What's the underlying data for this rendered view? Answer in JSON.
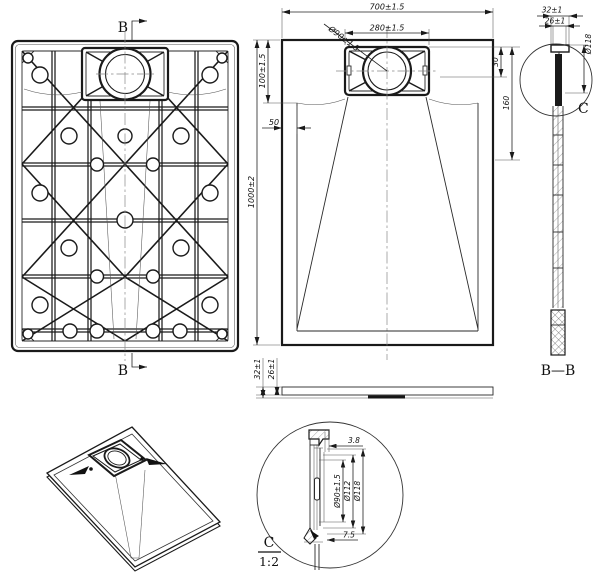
{
  "labels": {
    "section_marker": "B",
    "section_view_title": "B—B",
    "detail_marker": "C",
    "detail_title": "C",
    "detail_scale": "1:2"
  },
  "top_view": {
    "dim_width": "700±1.5",
    "dim_drain_cover_width": "280±1.5",
    "dim_drain_diameter": "Ø90±1.5",
    "dim_length": "1000±2",
    "dim_drain_zone_length": "100±1.5",
    "dim_side_border": "50",
    "dim_drain_top_offset": "30",
    "dim_drain_zone_depth": "160"
  },
  "side_profile": {
    "dim_total_height": "32±1",
    "dim_body_height": "26±1"
  },
  "section_bb": {
    "dim_total_thickness": "32±1",
    "dim_body_thickness": "26±1",
    "dim_flange_diameter": "Ø118"
  },
  "detail_c": {
    "dim_lip_width": "3.8",
    "dim_drain_diameter": "Ø90±1.5",
    "dim_ring_diameter": "Ø112",
    "dim_flange_diameter": "Ø118",
    "dim_foot_width": "7.5"
  }
}
